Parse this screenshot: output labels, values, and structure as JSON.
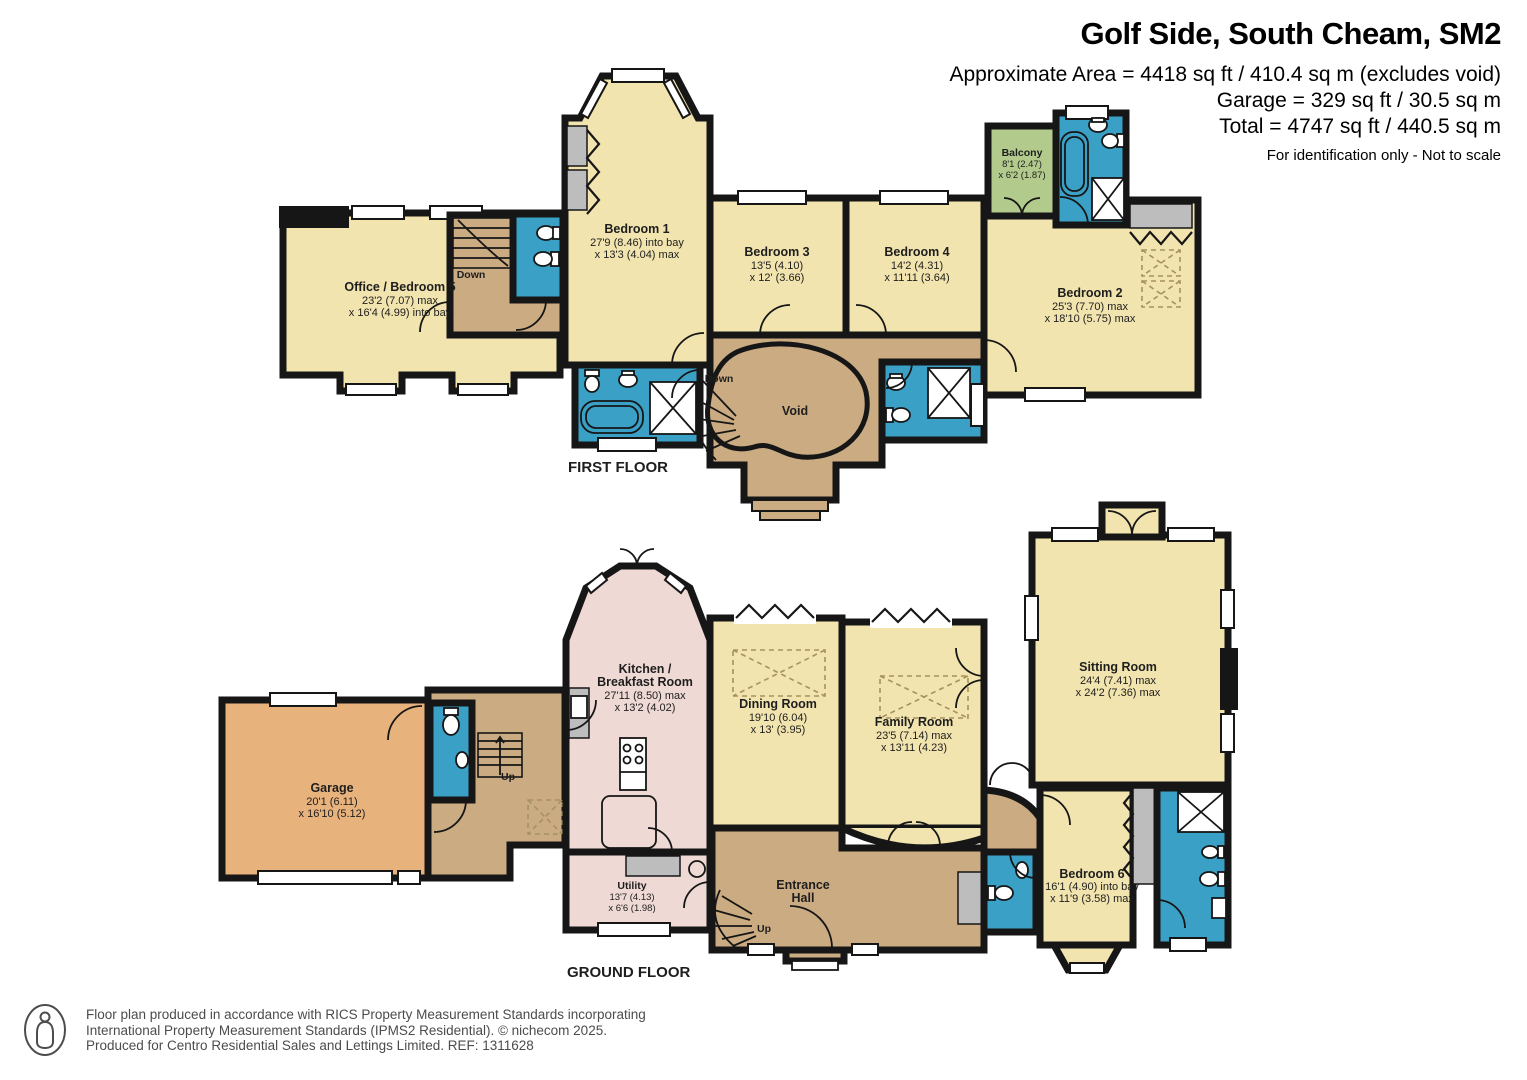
{
  "header": {
    "title": "Golf Side, South Cheam, SM2",
    "area_line": "Approximate Area = 4418 sq ft / 410.4 sq m (excludes void)",
    "garage_line": "Garage = 329 sq ft / 30.5 sq m",
    "total_line": "Total = 4747 sq ft / 440.5 sq m",
    "disclaimer": "For identification only - Not to scale"
  },
  "first_floor": {
    "label": "FIRST FLOOR",
    "office": {
      "name": "Office / Bedroom 5",
      "dim1": "23'2 (7.07) max",
      "dim2": "x 16'4 (4.99) into bay"
    },
    "bedroom1": {
      "name": "Bedroom 1",
      "dim1": "27'9 (8.46) into bay",
      "dim2": "x 13'3 (4.04) max"
    },
    "bedroom3": {
      "name": "Bedroom 3",
      "dim1": "13'5 (4.10)",
      "dim2": "x 12' (3.66)"
    },
    "bedroom4": {
      "name": "Bedroom 4",
      "dim1": "14'2 (4.31)",
      "dim2": "x 11'11 (3.64)"
    },
    "bedroom2": {
      "name": "Bedroom 2",
      "dim1": "25'3 (7.70) max",
      "dim2": "x 18'10 (5.75) max"
    },
    "balcony": {
      "name": "Balcony",
      "dim1": "8'1 (2.47)",
      "dim2": "x 6'2 (1.87)"
    },
    "void_label": "Void",
    "down1": "Down",
    "down2": "Down"
  },
  "ground_floor": {
    "label": "GROUND FLOOR",
    "garage": {
      "name": "Garage",
      "dim1": "20'1 (6.11)",
      "dim2": "x 16'10 (5.12)"
    },
    "kitchen": {
      "name1": "Kitchen /",
      "name2": "Breakfast Room",
      "dim1": "27'11 (8.50) max",
      "dim2": "x 13'2 (4.02)"
    },
    "dining": {
      "name": "Dining Room",
      "dim1": "19'10 (6.04)",
      "dim2": "x 13' (3.95)"
    },
    "family": {
      "name": "Family Room",
      "dim1": "23'5 (7.14) max",
      "dim2": "x 13'11 (4.23)"
    },
    "sitting": {
      "name": "Sitting Room",
      "dim1": "24'4 (7.41) max",
      "dim2": "x 24'2 (7.36) max"
    },
    "utility": {
      "name": "Utility",
      "dim1": "13'7 (4.13)",
      "dim2": "x 6'6 (1.98)"
    },
    "entrance": {
      "name1": "Entrance",
      "name2": "Hall"
    },
    "bedroom6": {
      "name": "Bedroom 6",
      "dim1": "16'1 (4.90) into bay",
      "dim2": "x 11'9 (3.58) max"
    },
    "up1": "Up",
    "up2": "Up"
  },
  "footer": {
    "line1": "Floor plan produced in accordance with RICS Property Measurement Standards incorporating",
    "line2": "International Property Measurement Standards (IPMS2 Residential).   © nichecom 2025.",
    "line3": "Produced for Centro Residential Sales and Lettings Limited.   REF: 1311628"
  },
  "colors": {
    "room_cream": "#f2e4ae",
    "hall_tan": "#cbab82",
    "garage_orange": "#e8b27d",
    "kitchen_pink": "#eed9d4",
    "bathroom_blue": "#3ba0c6",
    "balcony_green": "#b2cb8d",
    "wardrobe_grey": "#bdbdbd",
    "wall_black": "#161616"
  }
}
